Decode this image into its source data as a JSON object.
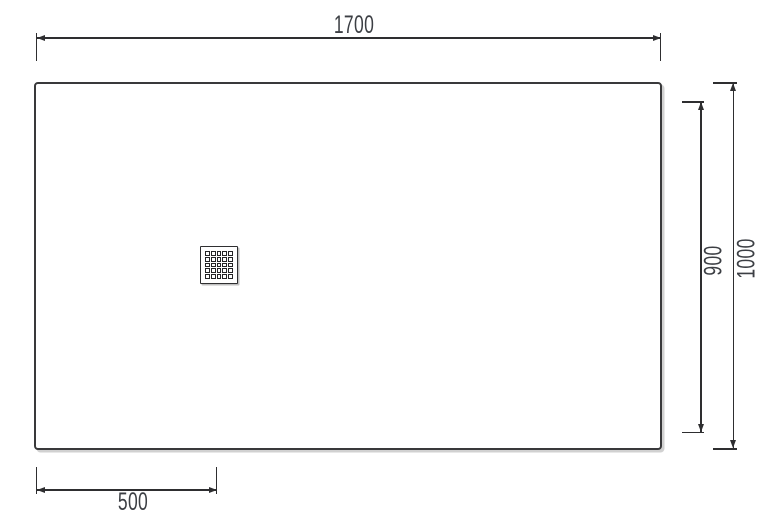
{
  "drawing": {
    "type": "technical-dimension-drawing",
    "subject": "rectangular shower tray top view with offset drain grate",
    "background_color": "#ffffff",
    "line_color": "#2e2e30",
    "text_color": "#3c3f44",
    "dimensions": {
      "top_width": {
        "label": "1700",
        "orientation": "horizontal",
        "position": "top"
      },
      "inner_height": {
        "label": "900",
        "orientation": "vertical",
        "position": "right-inner"
      },
      "total_height": {
        "label": "1000",
        "orientation": "vertical",
        "position": "right-outer"
      },
      "drain_offset": {
        "label": "500",
        "orientation": "horizontal",
        "position": "bottom-left"
      }
    },
    "drain": {
      "rows": 5,
      "cols": 5
    }
  }
}
